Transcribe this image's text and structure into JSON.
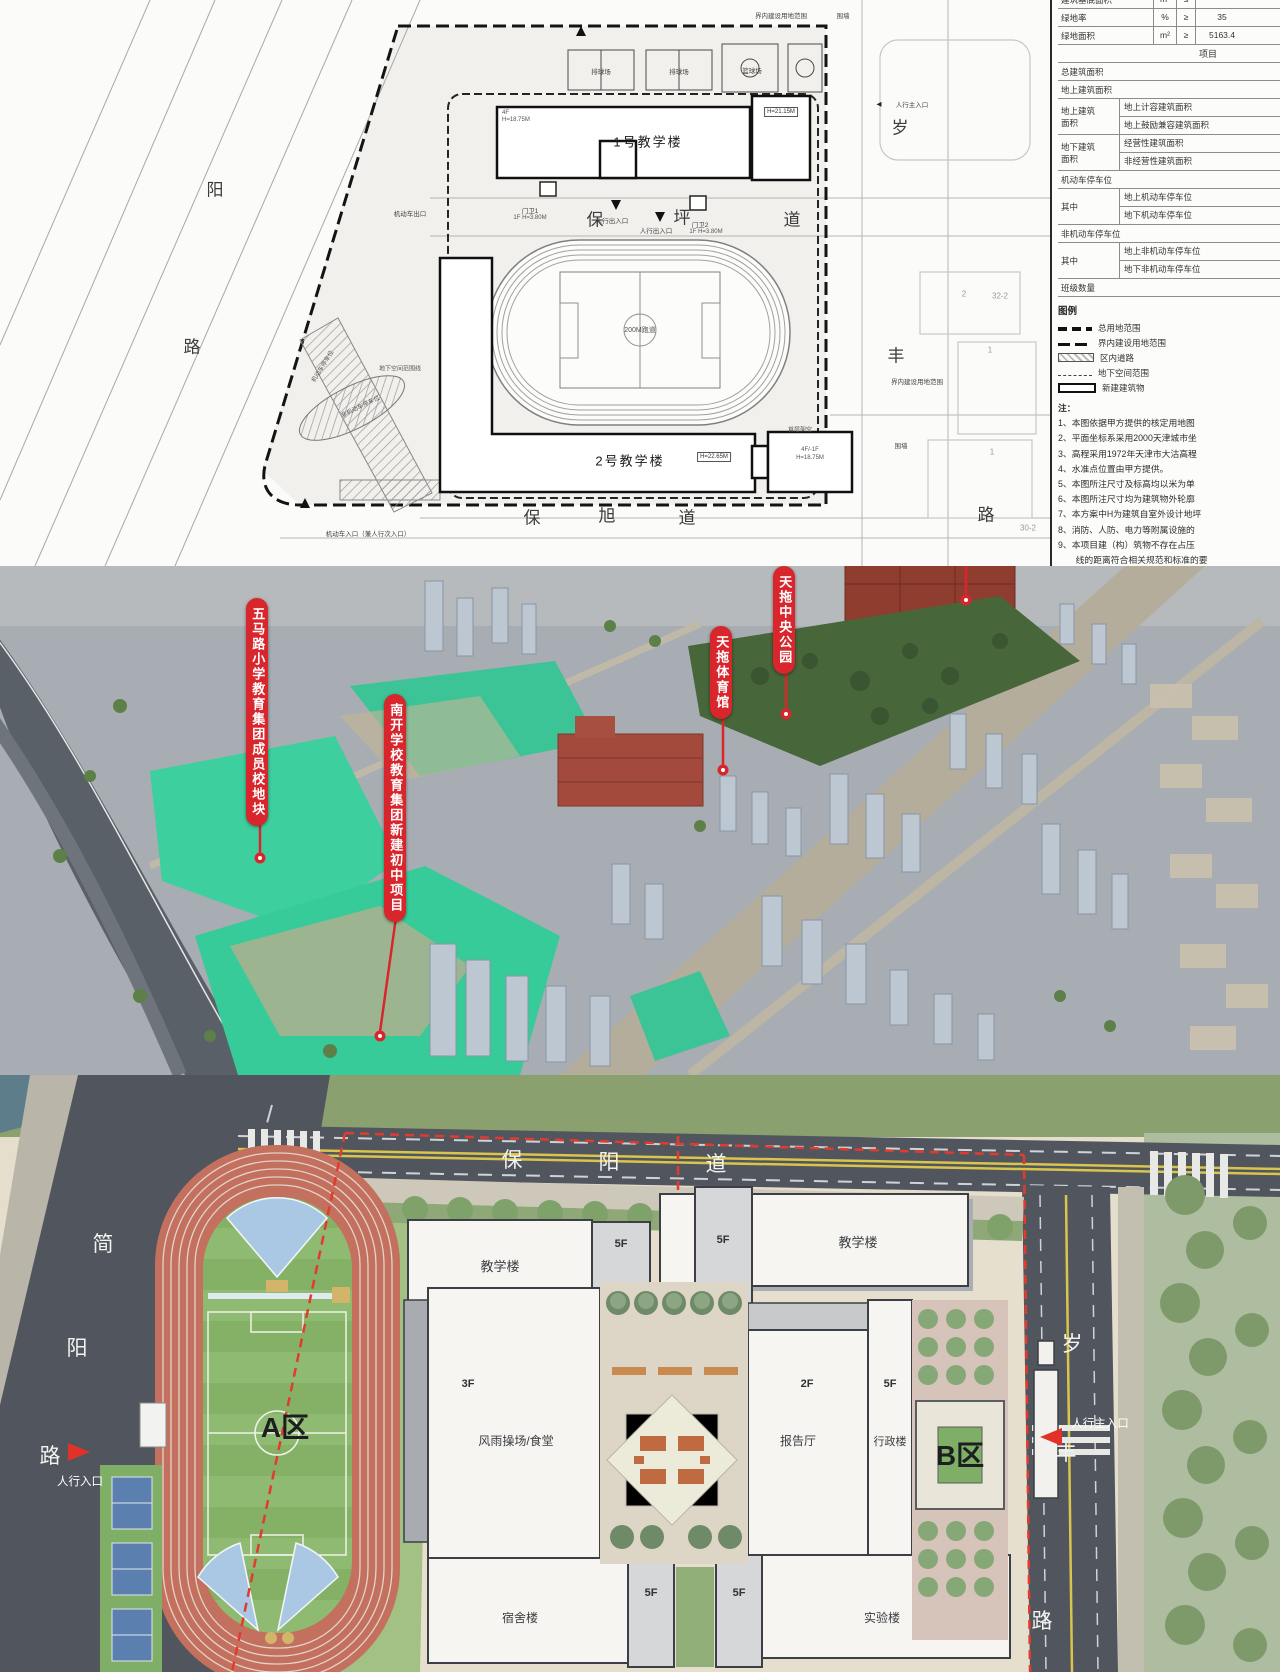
{
  "site_plan": {
    "building1": {
      "name": "1号教学楼",
      "h1": "4F",
      "h1b": "H=18.75M",
      "h2": "H=21.15M"
    },
    "building2": {
      "name": "2号教学楼",
      "h": "H=22.65M",
      "right_wing": "4F/-1F",
      "right_wing_h": "H=18.75M",
      "stilt": "首层架空"
    },
    "roads": {
      "baoping": [
        "保",
        "坪",
        "道"
      ],
      "baoxu": [
        "保",
        "旭",
        "道"
      ],
      "west": [
        "阳",
        "路"
      ],
      "east": [
        "岁",
        "丰"
      ],
      "southeast": "路"
    },
    "courts": {
      "volleyball": "排球场",
      "basketball": "篮球场"
    },
    "track_label": "200M跑道",
    "entrances": {
      "gate1": "门卫1",
      "gate1_h": "1F H=3.80M",
      "gate2": "门卫2",
      "gate2_h": "1F H=3.80M",
      "ped": "人行出入口",
      "ped_main": "人行主入口",
      "vehicle_exit": "机动车出口",
      "vehicle_in": "机动车入口（兼人行次入口）"
    },
    "annotations": {
      "inner_boundary": "界内建设用地范围",
      "wall": "围墙",
      "underground": "地下空间范围线",
      "bike_parking": "非机动车停车位",
      "car_parking": "机动车停车位"
    },
    "neighbors": {
      "n1": "32-2",
      "n2": "2",
      "n3": "1",
      "n4": "1",
      "n5": "30-2"
    },
    "table": {
      "rows_top": [
        {
          "label": "建筑基底面积",
          "unit": "m²",
          "op": "≤",
          "value": ""
        },
        {
          "label": "绿地率",
          "unit": "%",
          "op": "≥",
          "value": "35"
        },
        {
          "label": "绿地面积",
          "unit": "m²",
          "op": "≥",
          "value": "5163.4"
        }
      ],
      "section_header": "项目",
      "row_total": "总建筑面积",
      "row_above": "地上建筑面积",
      "groups": [
        {
          "l1": "地上建筑",
          "l2": "面积",
          "items": [
            "地上计容建筑面积",
            "地上鼓励兼容建筑面积"
          ]
        },
        {
          "l1": "地下建筑",
          "l2": "面积",
          "items": [
            "经营性建筑面积",
            "非经营性建筑面积"
          ]
        }
      ],
      "row_parking": "机动车停车位",
      "group_parking": {
        "l1": "其中",
        "items": [
          "地上机动车停车位",
          "地下机动车停车位"
        ]
      },
      "row_bike": "非机动车停车位",
      "group_bike": {
        "l1": "其中",
        "items": [
          "地上非机动车停车位",
          "地下非机动车停车位"
        ]
      },
      "row_class": "班级数量"
    },
    "legend": {
      "title": "图例",
      "items": [
        "总用地范围",
        "界内建设用地范围",
        "区内道路",
        "地下空间范围",
        "新建建筑物"
      ]
    },
    "notes_title": "注：",
    "notes": [
      "1、本图依据甲方提供的核定用地图",
      "2、平面坐标系采用2000天津城市坐",
      "3、高程采用1972年天津市大沽高程",
      "4、水准点位置由甲方提供。",
      "5、本图所注尺寸及标高均以米为单",
      "6、本图所注尺寸均为建筑物外轮廓",
      "7、本方案中H为建筑自室外设计地坪",
      "8、消防、人防、电力等附属设施的",
      "9、本项目建（构）筑物不存在占压",
      "　　线的距离符合相关规范和标准的要"
    ],
    "title_block": {
      "project": "天拖地块配套小学项目",
      "publish": "公示日期：2025年9月29日-2025年10"
    }
  },
  "aerial": {
    "labels": {
      "wumalu": "五马路小学教育集团成员校地块",
      "nankai": "南开学校教育集团新建初中项目",
      "stadium": "天拖体育馆",
      "park": "天拖中央公园"
    }
  },
  "master_plan": {
    "roads": {
      "baoyang": [
        "保",
        "阳",
        "道"
      ],
      "jianyang": [
        "简",
        "阳",
        "路"
      ],
      "suifeng": [
        "岁",
        "丰",
        "路"
      ]
    },
    "zones": {
      "a": "A区",
      "b": "B区"
    },
    "buildings": {
      "teaching": "教学楼",
      "gym": "风雨操场/食堂",
      "hall": "报告厅",
      "admin": "行政楼",
      "dorm": "宿舍楼",
      "lab": "实验楼"
    },
    "floors": {
      "f5": "5F",
      "f3": "3F",
      "f2": "2F"
    },
    "entrances": {
      "ped": "人行入口",
      "ped_main": "人行主入口"
    }
  },
  "icons": {
    "arrow_left": "◀",
    "arrow_down": "▼",
    "arrow_up": "▲"
  },
  "colors": {
    "label_red": "#d8262c",
    "boundary_red": "#e23b2e"
  }
}
